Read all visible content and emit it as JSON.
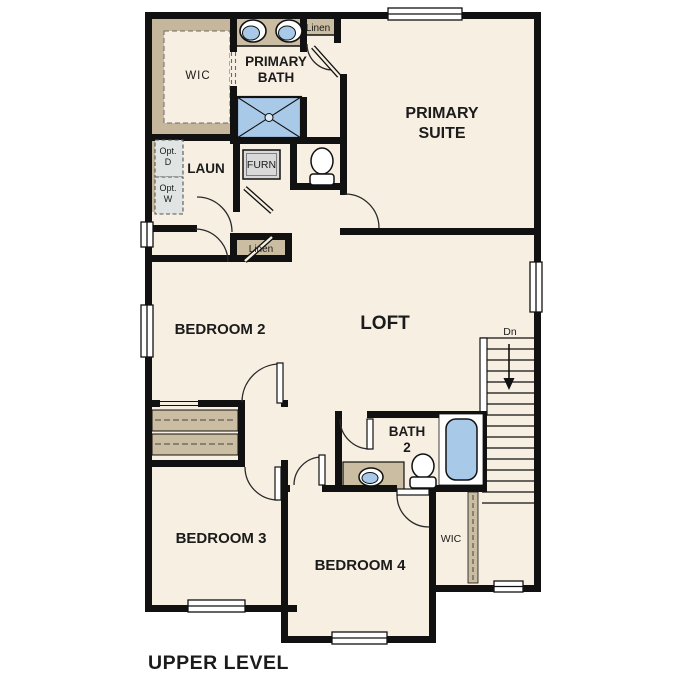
{
  "page": {
    "title": "UPPER LEVEL"
  },
  "colors": {
    "floor": "#f7efe2",
    "wall": "#111111",
    "casework_tan": "#cbbda1",
    "fixture_blue": "#a9c9e8",
    "furnace_grey": "#d9d9d9",
    "optional_grey": "#e0e4e3"
  },
  "rooms": {
    "wic_top": {
      "label": "WIC"
    },
    "primary_bath": {
      "label_line1": "PRIMARY",
      "label_line2": "BATH"
    },
    "linen_top": {
      "label": "Linen"
    },
    "primary_suite": {
      "label_line1": "PRIMARY",
      "label_line2": "SUITE"
    },
    "laundry": {
      "label": "LAUN"
    },
    "furnace": {
      "label": "FURN"
    },
    "opt_dryer": {
      "label_line1": "Opt.",
      "label_line2": "D"
    },
    "opt_washer": {
      "label_line1": "Opt.",
      "label_line2": "W"
    },
    "linen_hall": {
      "label": "Linen"
    },
    "bedroom2": {
      "label": "BEDROOM 2"
    },
    "loft": {
      "label": "LOFT"
    },
    "stairs": {
      "label": "Dn"
    },
    "bath2": {
      "label_line1": "BATH",
      "label_line2": "2"
    },
    "bedroom3": {
      "label": "BEDROOM 3"
    },
    "bedroom4": {
      "label": "BEDROOM 4"
    },
    "wic_bottom": {
      "label": "WIC"
    }
  }
}
